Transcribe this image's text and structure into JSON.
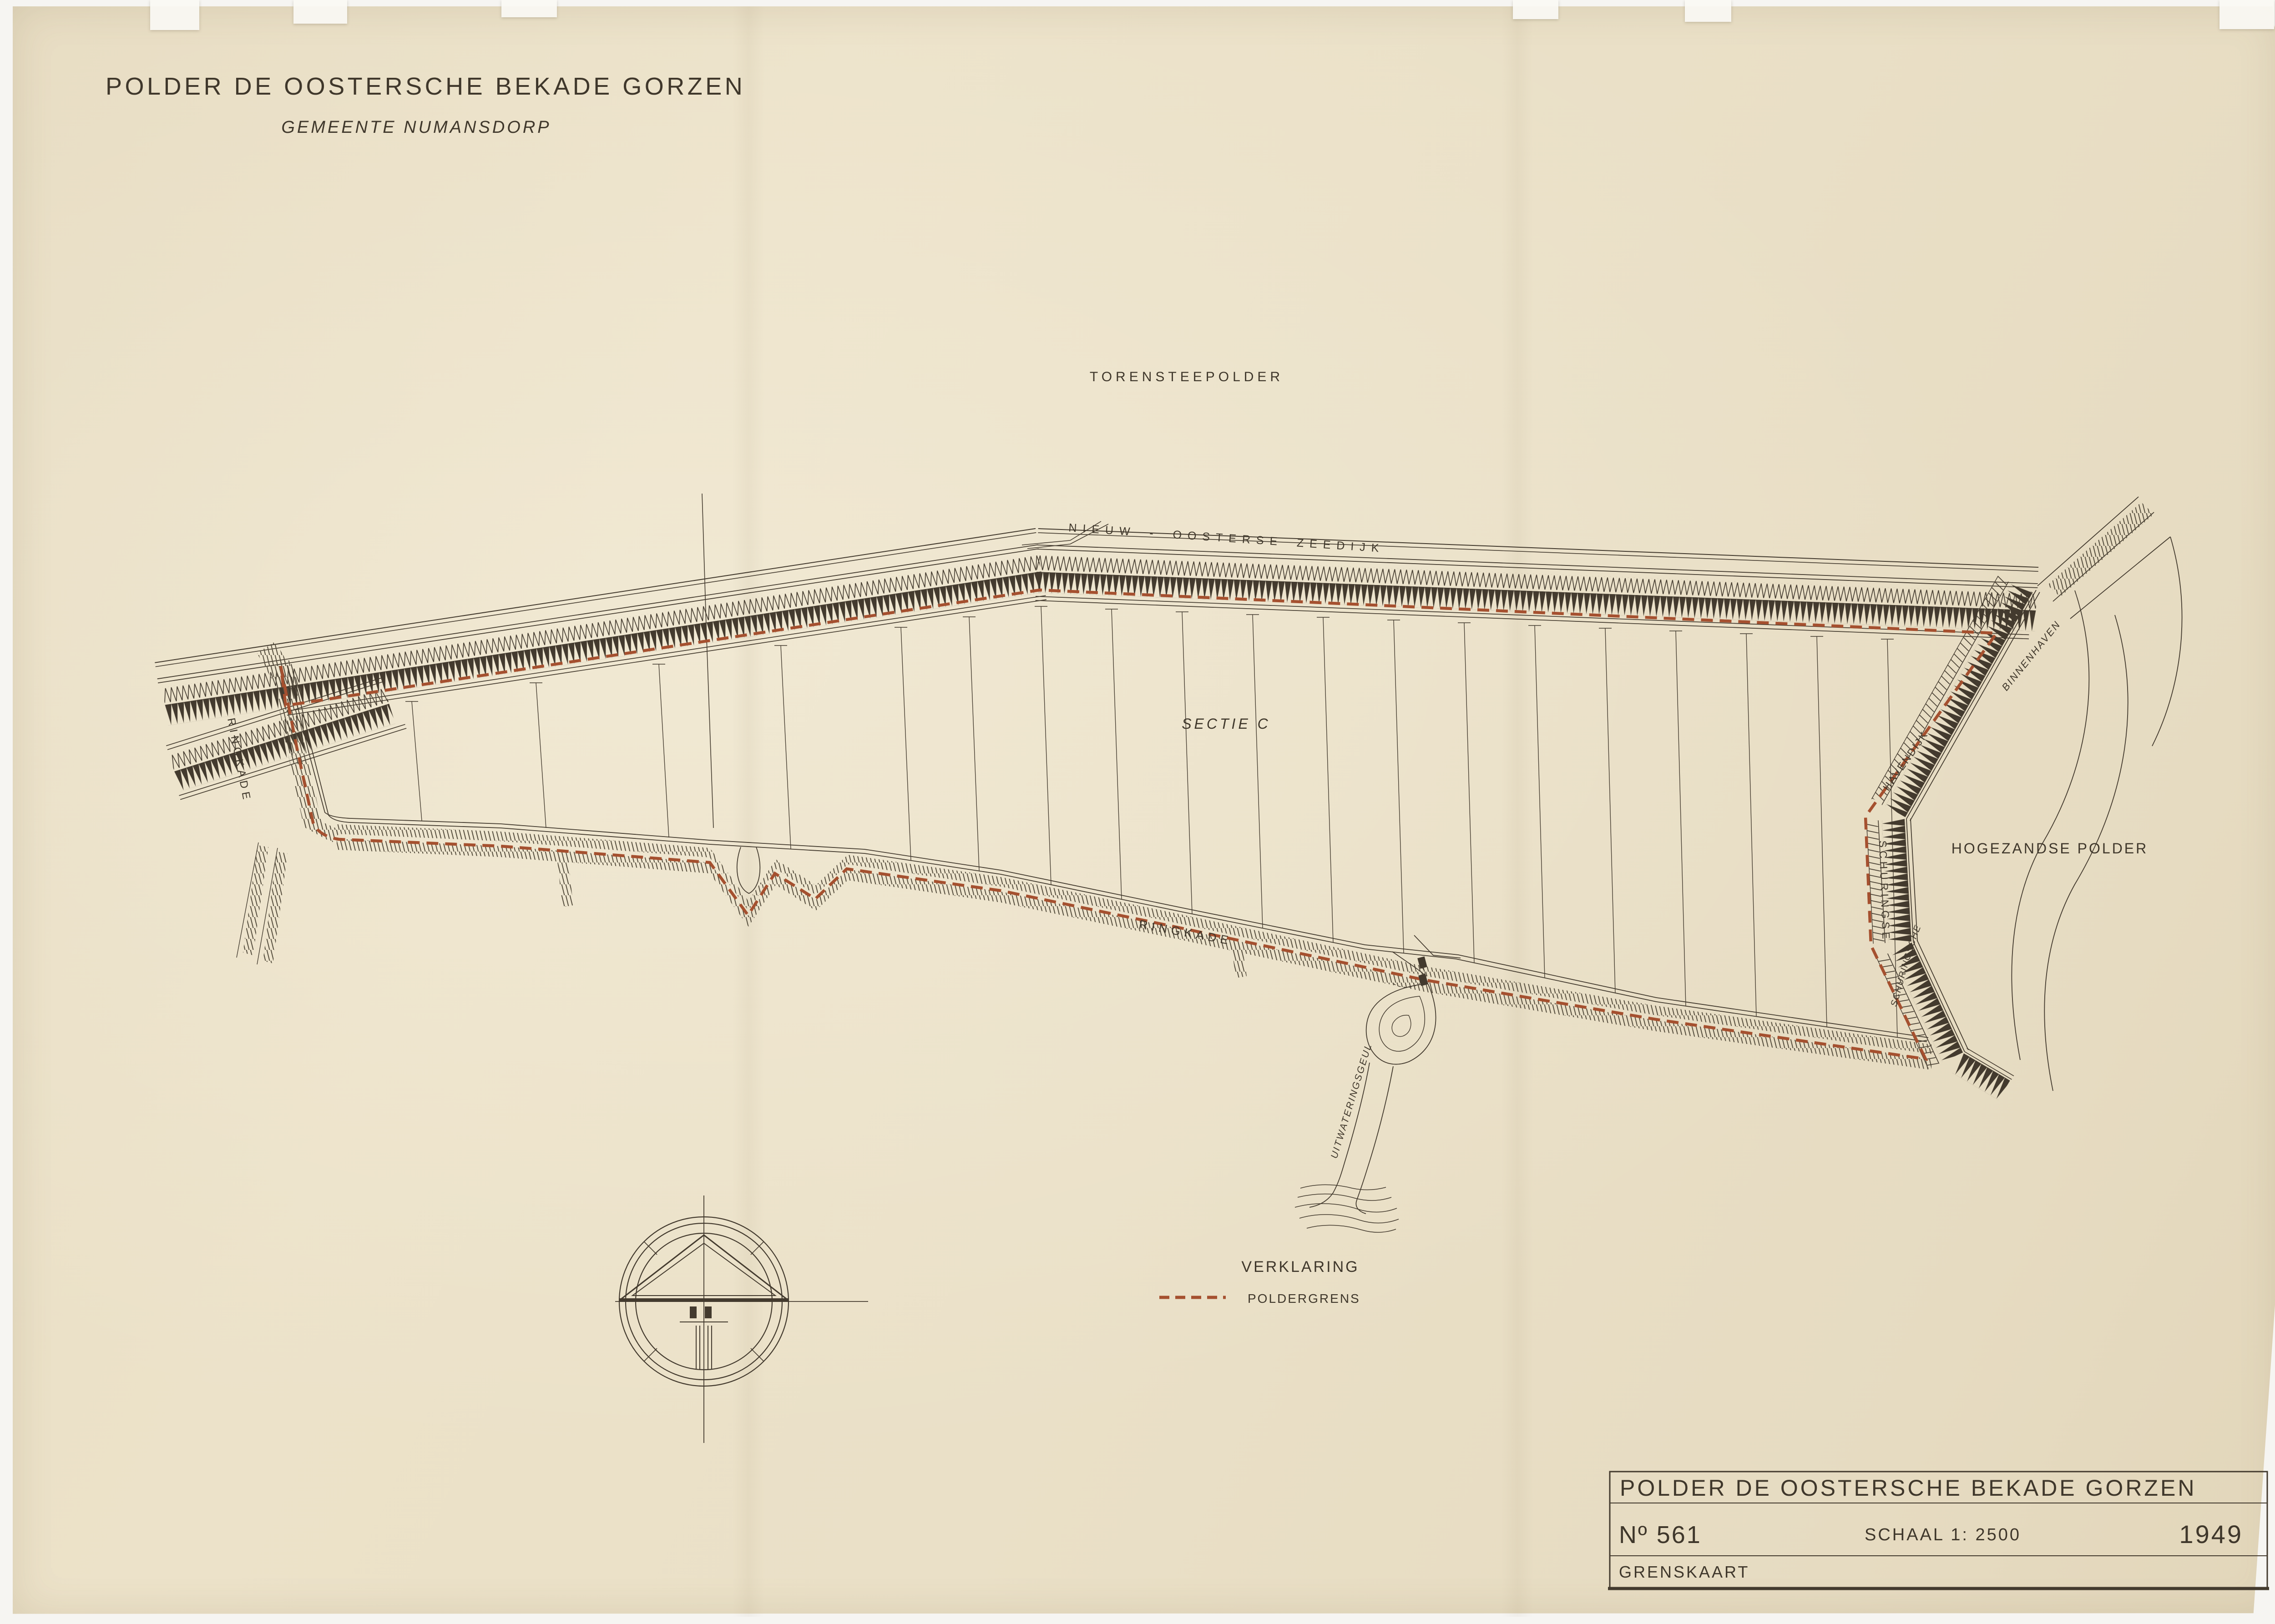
{
  "header": {
    "title": "POLDER DE OOSTERSCHE BEKADE GORZEN",
    "subtitle": "GEMEENTE NUMANSDORP"
  },
  "map": {
    "labels": {
      "torensteepolder": "TORENSTEEPOLDER",
      "sectie": "SECTIE  C",
      "hogezandse_polder": "HOGEZANDSE   POLDER",
      "zeedijk": "NIEUW  -  OOSTERSE   ZEEDIJK",
      "ringkade_south": "RINGKADE",
      "ringkade_west": "RINGKADE",
      "schuringse": "SCHURINGSE",
      "havendijk": "HAVENDIJK",
      "binnenhaven": "BINNENHAVEN",
      "schuringsche": "SCHURINGSCHE",
      "uitwateringsgeul": "UITWATERINGSGEUL"
    },
    "colors": {
      "ink": "#433a2e",
      "boundary_red": "#a5502f",
      "paper": "#eae0c7"
    }
  },
  "legend": {
    "title": "VERKLARING",
    "items": [
      {
        "label": "POLDERGRENS",
        "symbol": "red-dashed-line"
      }
    ]
  },
  "title_block": {
    "title": "POLDER DE OOSTERSCHE BEKADE GORZEN",
    "number_label": "Nº 561",
    "scale_label": "SCHAAL 1: 2500",
    "year": "1949",
    "type_label": "GRENSKAART"
  }
}
